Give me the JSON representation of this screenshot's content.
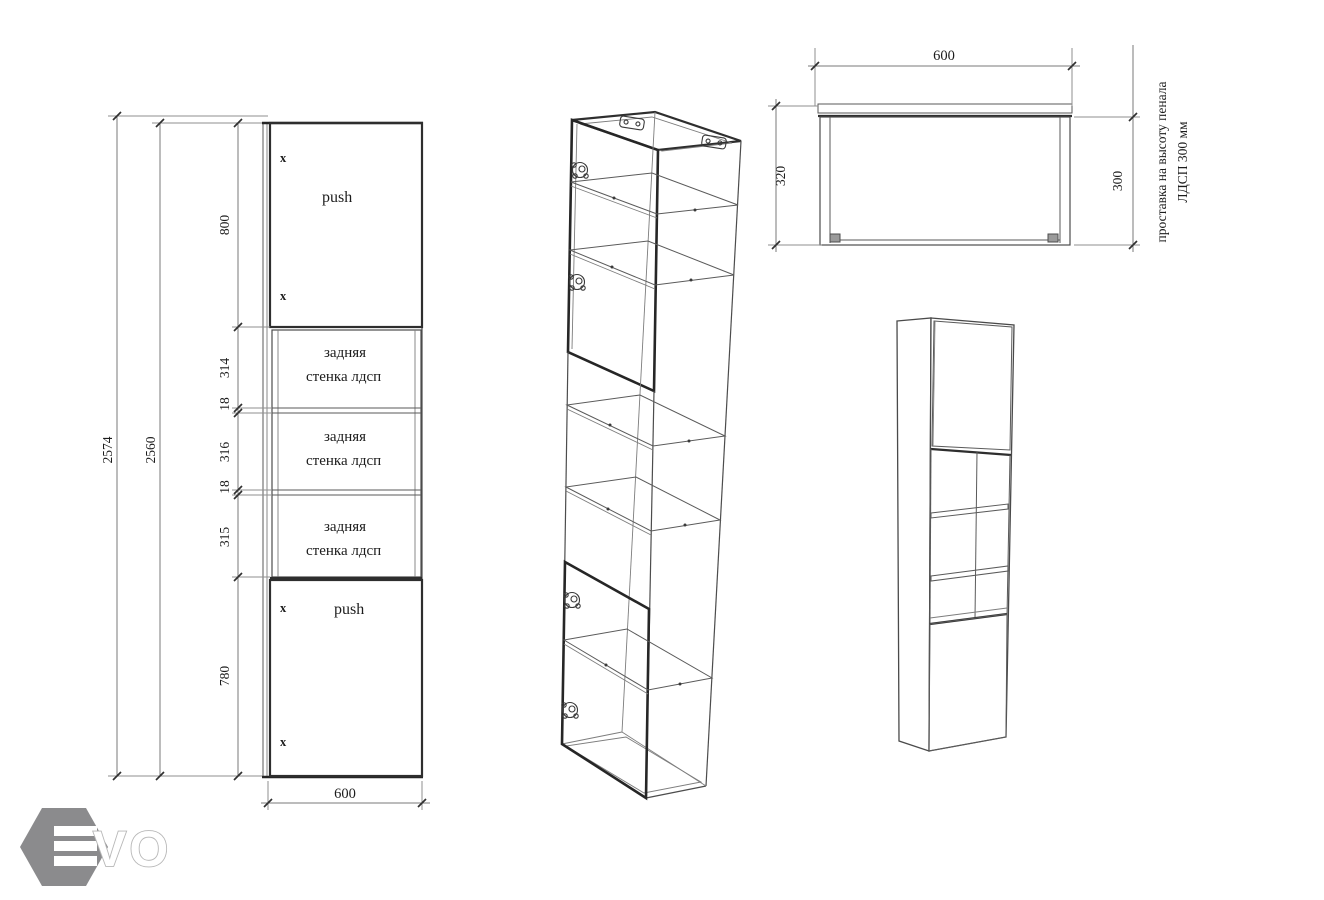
{
  "front_view": {
    "height_outer": "2574",
    "height_inner": "2560",
    "chain": [
      "800",
      "314",
      "18",
      "316",
      "18",
      "315",
      "780"
    ],
    "width": "600",
    "top_door": {
      "x_top": "x",
      "x_bottom": "x",
      "push": "push"
    },
    "bottom_door": {
      "x_top": "x",
      "x_bottom": "x",
      "push": "push"
    },
    "back_panels": [
      {
        "l1": "задняя",
        "l2": "стенка лдсп"
      },
      {
        "l1": "задняя",
        "l2": "стенка лдсп"
      },
      {
        "l1": "задняя",
        "l2": "стенка лдсп"
      }
    ]
  },
  "top_view": {
    "width": "600",
    "depth_total": "320",
    "depth_body": "300",
    "note1": "проставка на высоту пенала",
    "note2": "ЛДСП  300 мм"
  },
  "logo": {
    "letters": "VO",
    "hex_color": "#8b8b8d",
    "outline_color": "#b7b7b7"
  },
  "colors": {
    "line": "#4c4c4c",
    "thick_line": "#262626",
    "background": "#ffffff"
  }
}
